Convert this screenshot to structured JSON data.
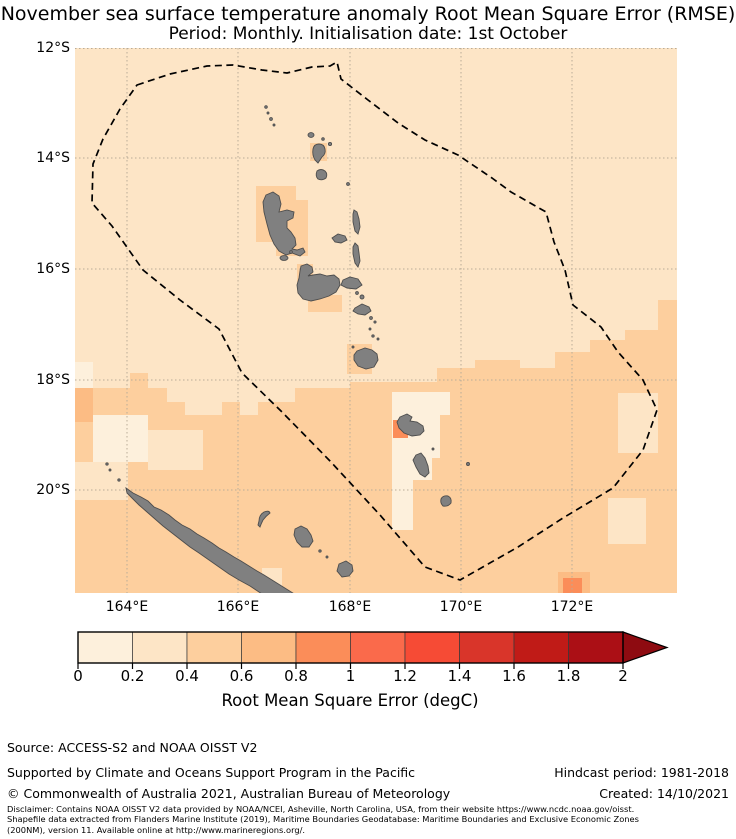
{
  "title": {
    "line1": "November sea surface temperature anomaly Root Mean Square Error (RMSE)",
    "line2": "Period: Monthly. Initialisation date: 1st October"
  },
  "map": {
    "lat_ticks": [
      {
        "label": "12°S",
        "y": 48
      },
      {
        "label": "14°S",
        "y": 158
      },
      {
        "label": "16°S",
        "y": 269
      },
      {
        "label": "18°S",
        "y": 380
      },
      {
        "label": "20°S",
        "y": 490
      }
    ],
    "lon_ticks": [
      {
        "label": "164°E",
        "x": 127
      },
      {
        "label": "166°E",
        "x": 238
      },
      {
        "label": "168°E",
        "x": 350
      },
      {
        "label": "170°E",
        "x": 461
      },
      {
        "label": "172°E",
        "x": 572
      }
    ],
    "boundary_name": "eez-dashed-boundary"
  },
  "colorbar": {
    "title": "Root Mean Square Error (degC)",
    "tick_labels": [
      "0",
      "0.2",
      "0.4",
      "0.6",
      "0.8",
      "1",
      "1.2",
      "1.4",
      "1.6",
      "1.8",
      "2"
    ],
    "range": [
      0,
      2
    ],
    "bin_width": 0.2,
    "segment_colors": [
      "#fdf0dc",
      "#fde5c6",
      "#fdcf9e",
      "#fcbc84",
      "#fb8d59",
      "#fa6a4b",
      "#f64b35",
      "#d9352a",
      "#c01b17",
      "#ab0f15"
    ],
    "arrow_color": "#8e0b11"
  },
  "footer": {
    "source": "Source: ACCESS-S2 and NOAA OISST V2",
    "supported": "Supported by Climate and Oceans Support Program in the Pacific",
    "copyright": "© Commonwealth of Australia 2021, Australian Bureau of Meteorology",
    "hindcast": "Hindcast period: 1981-2018",
    "created": "Created: 14/10/2021",
    "disclaimer": [
      "Disclaimer: Contains NOAA OISST V2 data provided by NOAA/NCEI, Asheville, North Carolina, USA, from their website https://www.ncdc.noaa.gov/oisst.",
      "Shapefile data extracted from Flanders Marine Institute (2019), Maritime Boundaries Geodatabase: Maritime Boundaries and Exclusive Economic Zones",
      "(200NM), version 11. Available online at http://www.marineregions.org/."
    ]
  },
  "colors": {
    "map_background": "#fde5c6",
    "island_fill": "#808080",
    "island_outline": "#4d4d4d",
    "eez_line": "#000000",
    "gridline": "#b9ac98"
  }
}
